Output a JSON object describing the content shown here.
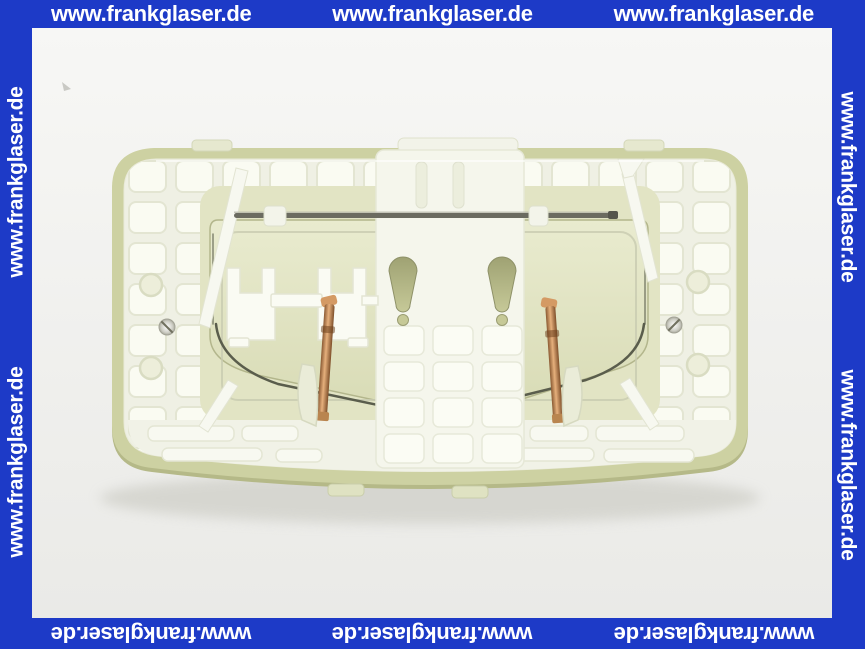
{
  "watermark": {
    "text": "www.frankglaser.de",
    "placements": {
      "top": 3,
      "bottom": 3,
      "left": 2,
      "right": 2
    },
    "bar_color": "#1d3ac7",
    "text_color": "#ffffff"
  },
  "photo": {
    "subject": "Rear view of a white plastic WC flush actuator plate with two copper spring clips, two keyhole mounting slots and a metal actuating rod",
    "background_color": "#f3f3f1",
    "colors": {
      "plastic_white": "#f5f6ec",
      "rim_olive": "#cdd1a2",
      "recess_green": "#e2e4c4",
      "keyhole_olive": "#aeb181",
      "spring_copper": "#c08552",
      "rod_gray": "#6b6b60"
    }
  }
}
